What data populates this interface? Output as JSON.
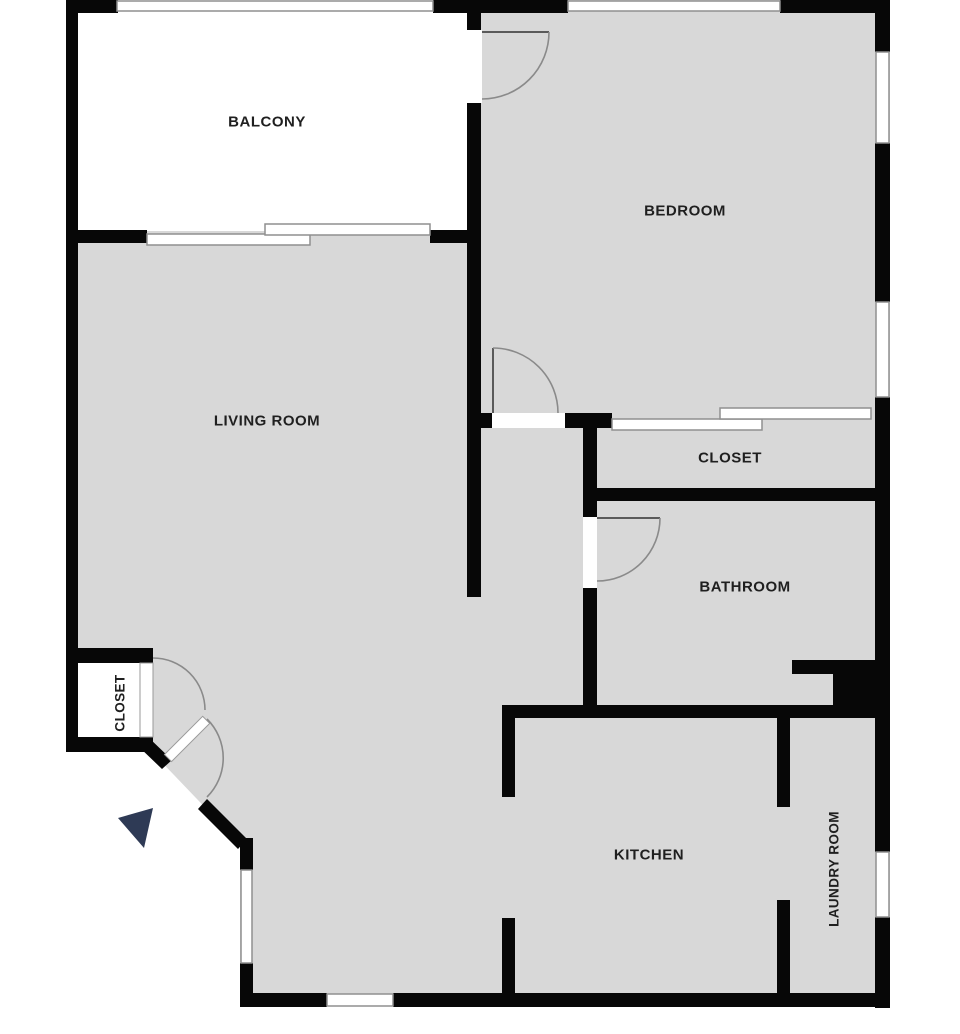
{
  "plan": {
    "type": "apartment-floor-plan",
    "rooms": {
      "balcony": {
        "label": "BALCONY"
      },
      "bedroom": {
        "label": "BEDROOM"
      },
      "living_room": {
        "label": "LIVING ROOM"
      },
      "closet_hall": {
        "label": "CLOSET"
      },
      "bathroom": {
        "label": "BATHROOM"
      },
      "kitchen": {
        "label": "KITCHEN"
      },
      "laundry_room": {
        "label": "LAUNDRY ROOM"
      },
      "closet_entry": {
        "label": "CLOSET"
      }
    },
    "markers": {
      "entry_direction": {
        "shape": "triangle",
        "color": "#2e3a55"
      }
    },
    "colors": {
      "floor_fill": "#d8d8d8",
      "wall": "#070707",
      "exterior": "#ffffff",
      "window_frame": "#8f8f8f",
      "door_arc": "#8a8a8a",
      "label_text": "#1f1f1f"
    }
  }
}
